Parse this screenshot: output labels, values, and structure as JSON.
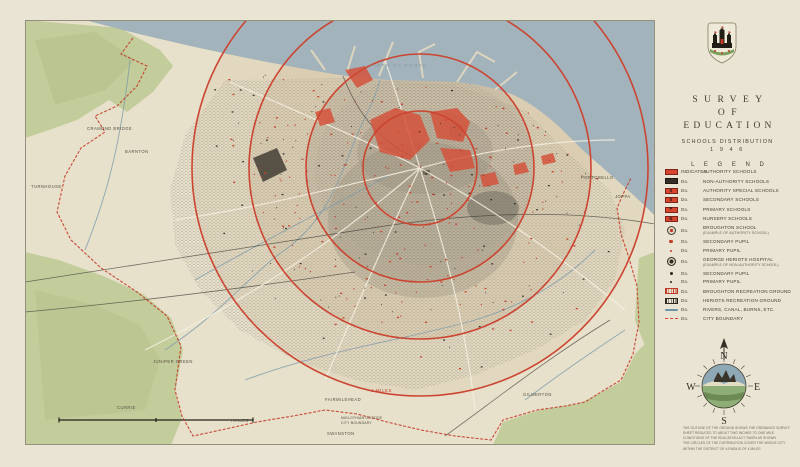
{
  "panel": {
    "title": {
      "line1": "SURVEY",
      "line2": "OF",
      "line3": "EDUCATION"
    },
    "subtitle": "SCHOOLS  DISTRIBUTION",
    "year": "1 9 4 6",
    "legend_title": "L E G E N D",
    "legend": [
      {
        "symbol": "rect-red-solid",
        "prefix": "INDICATES",
        "label": "AUTHORITY  SCHOOLS"
      },
      {
        "symbol": "rect-black",
        "prefix": "Do.",
        "label": "NON-AUTHORITY  SCHOOLS"
      },
      {
        "symbol": "rect-red-s",
        "letter": "S",
        "prefix": "Do.",
        "label": "AUTHORITY  SPECIAL  SCHOOLS"
      },
      {
        "symbol": "rect-red-sec",
        "letter": "S",
        "prefix": "Do.",
        "label": "SECONDARY  SCHOOLS"
      },
      {
        "symbol": "rect-red-pri",
        "letter": "P",
        "prefix": "Do.",
        "label": "PRIMARY  SCHOOLS"
      },
      {
        "symbol": "rect-red-nur",
        "letter": "N",
        "prefix": "Do.",
        "label": "NURSERY  SCHOOLS"
      },
      {
        "symbol": "badge-red",
        "prefix": "Do.",
        "label": "BROUGHTON  SCHOOL",
        "sub": "(EXAMPLE OF AUTHORITY SCHOOL)"
      },
      {
        "symbol": "dot-red-lg",
        "prefix": "Do.",
        "label": "SECONDARY  PUPIL"
      },
      {
        "symbol": "dot-red-sm",
        "prefix": "Do.",
        "label": "PRIMARY  PUPIL"
      },
      {
        "symbol": "badge-black",
        "prefix": "Do.",
        "label": "GEORGE  HERIOTS  HOSPITAL",
        "sub": "(EXAMPLE OF NON-AUTHORITY SCHOOL)"
      },
      {
        "symbol": "dot-black-lg",
        "prefix": "Do.",
        "label": "SECONDARY  PUPIL"
      },
      {
        "symbol": "dot-black-sm",
        "prefix": "Do.",
        "label": "PRIMARY  PUPIL"
      },
      {
        "symbol": "rect-red-hatch",
        "prefix": "Do.",
        "label": "BROUGHTON  RECREATION  GROUND"
      },
      {
        "symbol": "rect-black-hatch",
        "prefix": "Do.",
        "label": "HERIOTS  RECREATION  GROUND"
      },
      {
        "symbol": "line-blue",
        "prefix": "Do.",
        "label": "RIVERS,  CANAL,  BURNS,  ETC."
      },
      {
        "symbol": "line-red-dash",
        "prefix": "Do.",
        "label": "CITY  BOUNDARY"
      }
    ],
    "compass": {
      "n": "N",
      "e": "E",
      "s": "S",
      "w": "W"
    },
    "attribution": [
      "THE OUTLINE OF THE GROUND SHOWS THE ORDNANCE SURVEY SHEET REDUCED TO ABOUT TWO INCHES TO ONE MILE",
      "CONDITIONS OF THE EDUCATION ACT TAKEN AS SHOWN",
      "THE CIRCLES OF THE DISTRIBUTION COVER THE WHOLE CITY WITHIN THE DISTRICT OF A RADIUS OF 4 MILES"
    ]
  },
  "map": {
    "rings_miles": [
      1,
      2,
      3,
      4
    ],
    "labels": [
      {
        "t": "FIRTH OF FORTH",
        "x": 345,
        "y": 47,
        "c": "sea"
      },
      {
        "t": "CRAMOND BRIDGE",
        "x": 62,
        "y": 110,
        "c": "pl"
      },
      {
        "t": "BARNTON",
        "x": 100,
        "y": 133,
        "c": "pl"
      },
      {
        "t": "TURNHOUSE",
        "x": 6,
        "y": 168,
        "c": "pl"
      },
      {
        "t": "PORTOBELLO",
        "x": 556,
        "y": 159,
        "c": "pl"
      },
      {
        "t": "JOPPA",
        "x": 590,
        "y": 178,
        "c": "pl"
      },
      {
        "t": "JUNIPER GREEN",
        "x": 128,
        "y": 343,
        "c": "pl"
      },
      {
        "t": "CURRIE",
        "x": 92,
        "y": 389,
        "c": "pl"
      },
      {
        "t": "HAILES",
        "x": 206,
        "y": 402,
        "c": "pl"
      },
      {
        "t": "FAIRMILEHEAD",
        "x": 300,
        "y": 381,
        "c": "pl"
      },
      {
        "t": "MIDLOTHIAN OUTSIDE",
        "x": 316,
        "y": 399,
        "c": "pl2"
      },
      {
        "t": "CITY BOUNDARY",
        "x": 316,
        "y": 404,
        "c": "pl2"
      },
      {
        "t": "SWANSTON",
        "x": 302,
        "y": 415,
        "c": "pl"
      },
      {
        "t": "GILMERTON",
        "x": 498,
        "y": 376,
        "c": "pl"
      },
      {
        "t": "4 MILES",
        "x": 346,
        "y": 372,
        "c": "ring"
      }
    ]
  },
  "colors": {
    "sheet": "#e9e4d3",
    "land": "#e7e0cb",
    "sea": "#a2b3bc",
    "green": "#c3cc9b",
    "ring_red": "#cc4531",
    "school_red": "#c8402c",
    "school_black": "#2f2b26",
    "boundary_red": "#c43b28"
  }
}
